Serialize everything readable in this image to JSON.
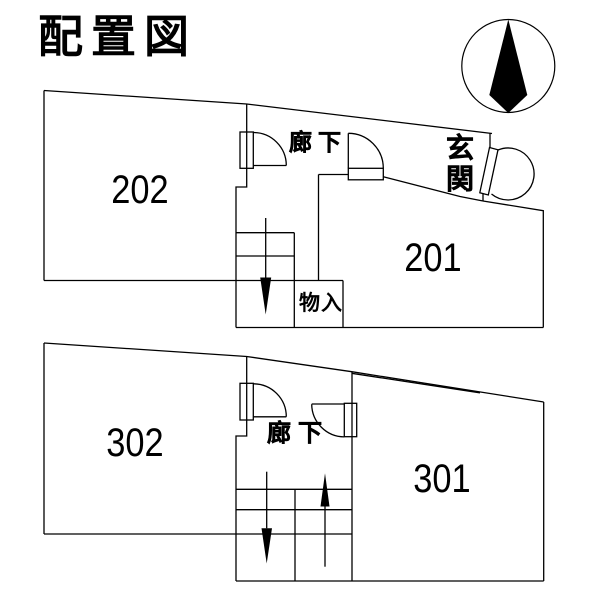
{
  "title": "配置図",
  "compass": {
    "icon": "north-arrow"
  },
  "plan2f": {
    "room_left": "202",
    "room_right": "201",
    "corridor": "廊下",
    "entrance": "玄関",
    "storage": "物入",
    "stairs": {
      "arrow": "down"
    }
  },
  "plan3f": {
    "room_left": "302",
    "room_right": "301",
    "corridor": "廊下",
    "stairs": {
      "arrows": [
        "down",
        "up"
      ]
    }
  },
  "colors": {
    "line": "#000000",
    "background": "#ffffff",
    "text": "#000000"
  }
}
